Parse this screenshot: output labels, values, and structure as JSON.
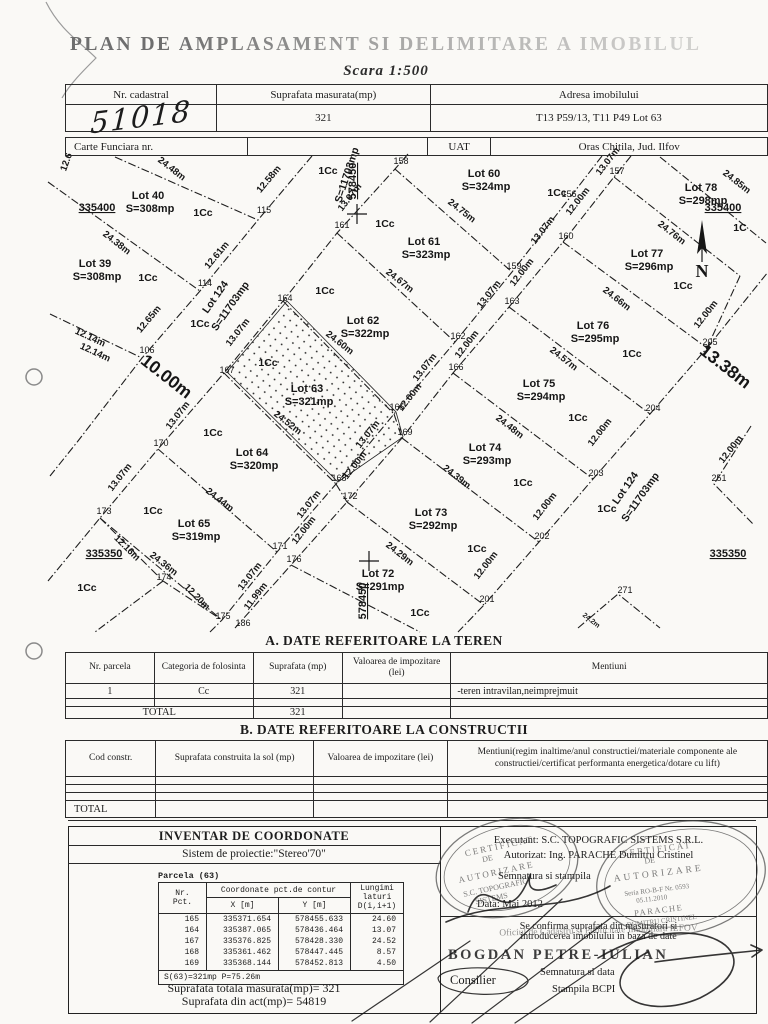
{
  "title": "PLAN DE AMPLASAMENT SI DELIMITARE A IMOBILULUI",
  "scale": "Scara 1:500",
  "header_table": {
    "c1": "Nr. cadastral",
    "c2": "Suprafata masurata(mp)",
    "c3": "Adresa imobilului",
    "v1": "51018",
    "v2": "321",
    "v3": "T13 P59/13, T11 P49 Lot 63"
  },
  "cf_table": {
    "label": "Carte Funciara nr.",
    "cf_value": "",
    "uat_label": "UAT",
    "uat_value": "Oras Chitila, Jud. Ilfov"
  },
  "section_a": {
    "heading": "A. DATE REFERITOARE LA TEREN",
    "headers": [
      "Nr. parcela",
      "Categoria de folosinta",
      "Suprafata (mp)",
      "Valoarea de impozitare (lei)",
      "Mentiuni"
    ],
    "rows": [
      [
        "1",
        "Cc",
        "321",
        "",
        "-teren intravilan,neimprejmuit"
      ]
    ],
    "total_label": "TOTAL",
    "total_value": "321"
  },
  "section_b": {
    "heading": "B. DATE REFERITOARE LA CONSTRUCTII",
    "headers": [
      "Cod constr.",
      "Suprafata construita la sol (mp)",
      "Valoarea de impozitare (lei)",
      "Mentiuni(regim inaltime/anul constructiei/materiale componente ale constructiei/certificat performanta energetica/dotare cu lift)"
    ],
    "total_label": "TOTAL"
  },
  "inventar": {
    "title": "INVENTAR DE COORDONATE",
    "subtitle": "Sistem de proiectie:\"Stereo'70\"",
    "parcela": "Parcela (63)",
    "col_nr": "Nr.\nPct.",
    "col_coord": "Coordonate pct.de contur",
    "col_x": "X [m]",
    "col_y": "Y [m]",
    "col_len": "Lungimi\nlaturi\nD(i,i+1)",
    "rows": [
      [
        "165",
        "335371.654",
        "578455.633",
        "24.60"
      ],
      [
        "164",
        "335387.065",
        "578436.464",
        "13.07"
      ],
      [
        "167",
        "335376.825",
        "578428.330",
        "24.52"
      ],
      [
        "168",
        "335361.462",
        "578447.445",
        "8.57"
      ],
      [
        "169",
        "335368.144",
        "578452.813",
        "4.50"
      ]
    ],
    "footer": "S(63)=321mp  P=75.26m",
    "total1": "Suprafata totala masurata(mp)= 321",
    "total2": "Suprafata din act(mp)= 54819"
  },
  "officials": {
    "executant": "Executant: S.C. TOPOGRAFIC SISTEMS S.R.L.",
    "autorizat": "Autorizat: Ing. PARACHE Dumitru Cristinel",
    "semnatura": "Semnatura si stampila",
    "data": "Data: Mai 2012",
    "confirm1": "Se confirma suprafata din masuratori si",
    "confirm2": "introducerea imobilului in baza de date",
    "oficiu": "Oficiul de Cadastru si Publicitate Imobiliara ILFOV",
    "nume": "BOGDAN PETRE-IULIAN",
    "functie": "Consilier",
    "semn_data": "Semnatura si data",
    "stampila": "Stampila BCPI",
    "stamp_a": {
      "l1": "CERTIFICAT",
      "l2": "DE",
      "l3": "AUTORIZARE",
      "l4": "S.C. TOPOGRAFIC",
      "l5": "SISTEMS"
    },
    "stamp_b": {
      "l1": "CERTIFICAT",
      "l2": "DE",
      "l3": "AUTORIZARE",
      "l4": "Seria RO-B-F Nr. 0593",
      "l5": "05.11.2010",
      "l6": "PARACHE",
      "l7": "DUMITRU CRISTINEL"
    }
  },
  "map": {
    "north_label": "N",
    "labels": [
      {
        "t": "Lot 40",
        "x": 148,
        "y": 199,
        "r": 0,
        "c": "lot"
      },
      {
        "t": "S=308mp",
        "x": 150,
        "y": 212,
        "r": 0,
        "c": "lot"
      },
      {
        "t": "Lot 39",
        "x": 95,
        "y": 267,
        "r": 0,
        "c": "lot"
      },
      {
        "t": "S=308mp",
        "x": 97,
        "y": 280,
        "r": 0,
        "c": "lot"
      },
      {
        "t": "Lot 60",
        "x": 484,
        "y": 177,
        "r": 0,
        "c": "lot"
      },
      {
        "t": "S=324mp",
        "x": 486,
        "y": 190,
        "r": 0,
        "c": "lot"
      },
      {
        "t": "Lot 61",
        "x": 424,
        "y": 245,
        "r": 0,
        "c": "lot"
      },
      {
        "t": "S=323mp",
        "x": 426,
        "y": 258,
        "r": 0,
        "c": "lot"
      },
      {
        "t": "Lot 62",
        "x": 363,
        "y": 324,
        "r": 0,
        "c": "lot"
      },
      {
        "t": "S=322mp",
        "x": 365,
        "y": 337,
        "r": 0,
        "c": "lot"
      },
      {
        "t": "Lot 63",
        "x": 307,
        "y": 392,
        "r": 0,
        "c": "lot"
      },
      {
        "t": "S=321mp",
        "x": 309,
        "y": 405,
        "r": 0,
        "c": "lot"
      },
      {
        "t": "Lot 64",
        "x": 252,
        "y": 456,
        "r": 0,
        "c": "lot"
      },
      {
        "t": "S=320mp",
        "x": 254,
        "y": 469,
        "r": 0,
        "c": "lot"
      },
      {
        "t": "Lot 65",
        "x": 194,
        "y": 527,
        "r": 0,
        "c": "lot"
      },
      {
        "t": "S=319mp",
        "x": 196,
        "y": 540,
        "r": 0,
        "c": "lot"
      },
      {
        "t": "Lot 78",
        "x": 701,
        "y": 191,
        "r": 0,
        "c": "lot"
      },
      {
        "t": "S=298mp",
        "x": 703,
        "y": 204,
        "r": 0,
        "c": "lot"
      },
      {
        "t": "Lot 77",
        "x": 647,
        "y": 257,
        "r": 0,
        "c": "lot"
      },
      {
        "t": "S=296mp",
        "x": 649,
        "y": 270,
        "r": 0,
        "c": "lot"
      },
      {
        "t": "Lot 76",
        "x": 593,
        "y": 329,
        "r": 0,
        "c": "lot"
      },
      {
        "t": "S=295mp",
        "x": 595,
        "y": 342,
        "r": 0,
        "c": "lot"
      },
      {
        "t": "Lot 75",
        "x": 539,
        "y": 387,
        "r": 0,
        "c": "lot"
      },
      {
        "t": "S=294mp",
        "x": 541,
        "y": 400,
        "r": 0,
        "c": "lot"
      },
      {
        "t": "Lot 74",
        "x": 485,
        "y": 451,
        "r": 0,
        "c": "lot"
      },
      {
        "t": "S=293mp",
        "x": 487,
        "y": 464,
        "r": 0,
        "c": "lot"
      },
      {
        "t": "Lot 73",
        "x": 431,
        "y": 516,
        "r": 0,
        "c": "lot"
      },
      {
        "t": "S=292mp",
        "x": 433,
        "y": 529,
        "r": 0,
        "c": "lot"
      },
      {
        "t": "Lot 72",
        "x": 378,
        "y": 577,
        "r": 0,
        "c": "lot"
      },
      {
        "t": "S=291mp",
        "x": 380,
        "y": 590,
        "r": 0,
        "c": "lot"
      },
      {
        "t": "Lot 124",
        "x": 218,
        "y": 299,
        "r": -55,
        "c": "road"
      },
      {
        "t": "S=11703mp",
        "x": 233,
        "y": 308,
        "r": -55,
        "c": "road"
      },
      {
        "t": "Lot 124",
        "x": 628,
        "y": 490,
        "r": -55,
        "c": "road"
      },
      {
        "t": "S=11703mp",
        "x": 643,
        "y": 499,
        "r": -55,
        "c": "road"
      },
      {
        "t": "S=11703mp",
        "x": 350,
        "y": 176,
        "r": -72,
        "c": "road"
      },
      {
        "t": "335400",
        "x": 97,
        "y": 211,
        "r": 0,
        "c": "coord"
      },
      {
        "t": "335400",
        "x": 723,
        "y": 211,
        "r": 0,
        "c": "coord"
      },
      {
        "t": "335350",
        "x": 104,
        "y": 557,
        "r": 0,
        "c": "coord"
      },
      {
        "t": "335350",
        "x": 728,
        "y": 557,
        "r": 0,
        "c": "coord"
      },
      {
        "t": "578450",
        "x": 356,
        "y": 181,
        "r": -90,
        "c": "coord"
      },
      {
        "t": "578450",
        "x": 366,
        "y": 601,
        "r": -90,
        "c": "coord"
      },
      {
        "t": "1Cc",
        "x": 203,
        "y": 216,
        "r": 0,
        "c": "cc"
      },
      {
        "t": "1Cc",
        "x": 148,
        "y": 281,
        "r": 0,
        "c": "cc"
      },
      {
        "t": "1Cc",
        "x": 200,
        "y": 327,
        "r": 0,
        "c": "cc"
      },
      {
        "t": "1Cc",
        "x": 328,
        "y": 174,
        "r": 0,
        "c": "cc"
      },
      {
        "t": "1Cc",
        "x": 385,
        "y": 227,
        "r": 0,
        "c": "cc"
      },
      {
        "t": "1Cc",
        "x": 557,
        "y": 196,
        "r": 0,
        "c": "cc"
      },
      {
        "t": "1Cc",
        "x": 268,
        "y": 366,
        "r": 0,
        "c": "cc"
      },
      {
        "t": "1Cc",
        "x": 325,
        "y": 294,
        "r": 0,
        "c": "cc"
      },
      {
        "t": "1Cc",
        "x": 683,
        "y": 289,
        "r": 0,
        "c": "cc"
      },
      {
        "t": "1C",
        "x": 740,
        "y": 231,
        "r": 0,
        "c": "cc"
      },
      {
        "t": "1Cc",
        "x": 632,
        "y": 357,
        "r": 0,
        "c": "cc"
      },
      {
        "t": "1Cc",
        "x": 578,
        "y": 421,
        "r": 0,
        "c": "cc"
      },
      {
        "t": "1Cc",
        "x": 523,
        "y": 486,
        "r": 0,
        "c": "cc"
      },
      {
        "t": "1Cc",
        "x": 477,
        "y": 552,
        "r": 0,
        "c": "cc"
      },
      {
        "t": "1Cc",
        "x": 420,
        "y": 616,
        "r": 0,
        "c": "cc"
      },
      {
        "t": "1Cc",
        "x": 213,
        "y": 436,
        "r": 0,
        "c": "cc"
      },
      {
        "t": "1Cc",
        "x": 153,
        "y": 514,
        "r": 0,
        "c": "cc"
      },
      {
        "t": "1Cc",
        "x": 87,
        "y": 591,
        "r": 0,
        "c": "cc"
      },
      {
        "t": "1Cc",
        "x": 607,
        "y": 512,
        "r": 0,
        "c": "cc"
      },
      {
        "t": "24.48m",
        "x": 170,
        "y": 171,
        "r": 38,
        "c": "dim"
      },
      {
        "t": "24.38m",
        "x": 115,
        "y": 245,
        "r": 38,
        "c": "dim"
      },
      {
        "t": "24.75m",
        "x": 460,
        "y": 213,
        "r": 38,
        "c": "dim"
      },
      {
        "t": "24.67m",
        "x": 398,
        "y": 283,
        "r": 38,
        "c": "dim"
      },
      {
        "t": "24.60m",
        "x": 338,
        "y": 345,
        "r": 38,
        "c": "dim"
      },
      {
        "t": "24.52m",
        "x": 286,
        "y": 425,
        "r": 38,
        "c": "dim"
      },
      {
        "t": "24.44m",
        "x": 218,
        "y": 502,
        "r": 38,
        "c": "dim"
      },
      {
        "t": "24.36m",
        "x": 162,
        "y": 566,
        "r": 38,
        "c": "dim"
      },
      {
        "t": "24.85m",
        "x": 735,
        "y": 184,
        "r": 38,
        "c": "dim"
      },
      {
        "t": "24.76m",
        "x": 670,
        "y": 235,
        "r": 38,
        "c": "dim"
      },
      {
        "t": "24.66m",
        "x": 615,
        "y": 301,
        "r": 38,
        "c": "dim"
      },
      {
        "t": "24.57m",
        "x": 562,
        "y": 361,
        "r": 38,
        "c": "dim"
      },
      {
        "t": "24.48m",
        "x": 508,
        "y": 429,
        "r": 38,
        "c": "dim"
      },
      {
        "t": "24.39m",
        "x": 455,
        "y": 479,
        "r": 38,
        "c": "dim"
      },
      {
        "t": "24.29m",
        "x": 398,
        "y": 556,
        "r": 38,
        "c": "dim"
      },
      {
        "t": "24.2m",
        "x": 590,
        "y": 622,
        "r": 38,
        "c": "sm"
      },
      {
        "t": "12.58m",
        "x": 271,
        "y": 181,
        "r": -50,
        "c": "dim"
      },
      {
        "t": "12.61m",
        "x": 219,
        "y": 257,
        "r": -50,
        "c": "dim"
      },
      {
        "t": "12.65m",
        "x": 151,
        "y": 321,
        "r": -50,
        "c": "dim"
      },
      {
        "t": "12.6",
        "x": 69,
        "y": 163,
        "r": -70,
        "c": "dim"
      },
      {
        "t": "13.07m",
        "x": 352,
        "y": 199,
        "r": -52,
        "c": "dim"
      },
      {
        "t": "13.07m",
        "x": 240,
        "y": 334,
        "r": -52,
        "c": "dim"
      },
      {
        "t": "13.07m",
        "x": 180,
        "y": 417,
        "r": -52,
        "c": "dim"
      },
      {
        "t": "13.07m",
        "x": 122,
        "y": 479,
        "r": -52,
        "c": "dim"
      },
      {
        "t": "13.07m",
        "x": 610,
        "y": 163,
        "r": -52,
        "c": "dim"
      },
      {
        "t": "12.00m",
        "x": 580,
        "y": 203,
        "r": -52,
        "c": "dim"
      },
      {
        "t": "13.07m",
        "x": 545,
        "y": 232,
        "r": -52,
        "c": "dim"
      },
      {
        "t": "12.00m",
        "x": 524,
        "y": 274,
        "r": -52,
        "c": "dim"
      },
      {
        "t": "13.07m",
        "x": 491,
        "y": 296,
        "r": -52,
        "c": "dim"
      },
      {
        "t": "12.00m",
        "x": 469,
        "y": 346,
        "r": -52,
        "c": "dim"
      },
      {
        "t": "13.07m",
        "x": 427,
        "y": 369,
        "r": -52,
        "c": "dim"
      },
      {
        "t": "12.00m",
        "x": 412,
        "y": 399,
        "r": -52,
        "c": "dim"
      },
      {
        "t": "13.07m",
        "x": 370,
        "y": 436,
        "r": -52,
        "c": "dim"
      },
      {
        "t": "12.00m",
        "x": 357,
        "y": 467,
        "r": -52,
        "c": "dim"
      },
      {
        "t": "13.07m",
        "x": 311,
        "y": 506,
        "r": -52,
        "c": "dim"
      },
      {
        "t": "12.00m",
        "x": 306,
        "y": 532,
        "r": -52,
        "c": "dim"
      },
      {
        "t": "13.07m",
        "x": 252,
        "y": 578,
        "r": -52,
        "c": "dim"
      },
      {
        "t": "11.99m",
        "x": 258,
        "y": 598,
        "r": -52,
        "c": "dim"
      },
      {
        "t": "12.00m",
        "x": 708,
        "y": 316,
        "r": -52,
        "c": "dim"
      },
      {
        "t": "12.00m",
        "x": 602,
        "y": 434,
        "r": -52,
        "c": "dim"
      },
      {
        "t": "12.00m",
        "x": 547,
        "y": 508,
        "r": -52,
        "c": "dim"
      },
      {
        "t": "12.00m",
        "x": 488,
        "y": 567,
        "r": -52,
        "c": "dim"
      },
      {
        "t": "12.00m",
        "x": 733,
        "y": 451,
        "r": -52,
        "c": "dim"
      },
      {
        "t": "12.14m",
        "x": 89,
        "y": 340,
        "r": 25,
        "c": "dim"
      },
      {
        "t": "12.14m",
        "x": 94,
        "y": 355,
        "r": 25,
        "c": "dim"
      },
      {
        "t": "12.16m",
        "x": 125,
        "y": 550,
        "r": 45,
        "c": "dim"
      },
      {
        "t": "12.20m",
        "x": 195,
        "y": 599,
        "r": 45,
        "c": "dim"
      },
      {
        "t": "10.00m",
        "x": 163,
        "y": 381,
        "r": 38,
        "c": "big"
      },
      {
        "t": "13.38m",
        "x": 722,
        "y": 371,
        "r": 38,
        "c": "big"
      },
      {
        "t": "115",
        "x": 264,
        "y": 213,
        "r": 0,
        "c": "pt"
      },
      {
        "t": "114",
        "x": 205,
        "y": 286,
        "r": 0,
        "c": "pt"
      },
      {
        "t": "106",
        "x": 147,
        "y": 353,
        "r": 0,
        "c": "pt"
      },
      {
        "t": "158",
        "x": 401,
        "y": 164,
        "r": 0,
        "c": "pt"
      },
      {
        "t": "161",
        "x": 342,
        "y": 228,
        "r": 0,
        "c": "pt"
      },
      {
        "t": "164",
        "x": 285,
        "y": 301,
        "r": 0,
        "c": "pt"
      },
      {
        "t": "167",
        "x": 227,
        "y": 373,
        "r": 0,
        "c": "pt"
      },
      {
        "t": "170",
        "x": 161,
        "y": 446,
        "r": 0,
        "c": "pt"
      },
      {
        "t": "173",
        "x": 104,
        "y": 514,
        "r": 0,
        "c": "pt"
      },
      {
        "t": "174",
        "x": 164,
        "y": 580,
        "r": 0,
        "c": "pt"
      },
      {
        "t": "175",
        "x": 223,
        "y": 619,
        "r": 0,
        "c": "pt"
      },
      {
        "t": "186",
        "x": 243,
        "y": 626,
        "r": 0,
        "c": "pt"
      },
      {
        "t": "157",
        "x": 617,
        "y": 174,
        "r": 0,
        "c": "pt"
      },
      {
        "t": "156",
        "x": 569,
        "y": 197,
        "r": 0,
        "c": "pt"
      },
      {
        "t": "160",
        "x": 566,
        "y": 239,
        "r": 0,
        "c": "pt"
      },
      {
        "t": "159",
        "x": 514,
        "y": 269,
        "r": 0,
        "c": "pt"
      },
      {
        "t": "163",
        "x": 512,
        "y": 304,
        "r": 0,
        "c": "pt"
      },
      {
        "t": "162",
        "x": 458,
        "y": 339,
        "r": 0,
        "c": "pt"
      },
      {
        "t": "166",
        "x": 456,
        "y": 370,
        "r": 0,
        "c": "pt"
      },
      {
        "t": "165",
        "x": 397,
        "y": 410,
        "r": 0,
        "c": "pt"
      },
      {
        "t": "169",
        "x": 405,
        "y": 435,
        "r": 0,
        "c": "pt"
      },
      {
        "t": "168",
        "x": 339,
        "y": 481,
        "r": 0,
        "c": "pt"
      },
      {
        "t": "172",
        "x": 350,
        "y": 499,
        "r": 0,
        "c": "pt"
      },
      {
        "t": "171",
        "x": 280,
        "y": 549,
        "r": 0,
        "c": "pt"
      },
      {
        "t": "176",
        "x": 294,
        "y": 562,
        "r": 0,
        "c": "pt"
      },
      {
        "t": "205",
        "x": 710,
        "y": 345,
        "r": 0,
        "c": "pt"
      },
      {
        "t": "204",
        "x": 653,
        "y": 411,
        "r": 0,
        "c": "pt"
      },
      {
        "t": "203",
        "x": 596,
        "y": 476,
        "r": 0,
        "c": "pt"
      },
      {
        "t": "202",
        "x": 542,
        "y": 539,
        "r": 0,
        "c": "pt"
      },
      {
        "t": "201",
        "x": 487,
        "y": 602,
        "r": 0,
        "c": "pt"
      },
      {
        "t": "251",
        "x": 719,
        "y": 481,
        "r": 0,
        "c": "pt"
      },
      {
        "t": "271",
        "x": 625,
        "y": 593,
        "r": 0,
        "c": "pt"
      }
    ]
  }
}
